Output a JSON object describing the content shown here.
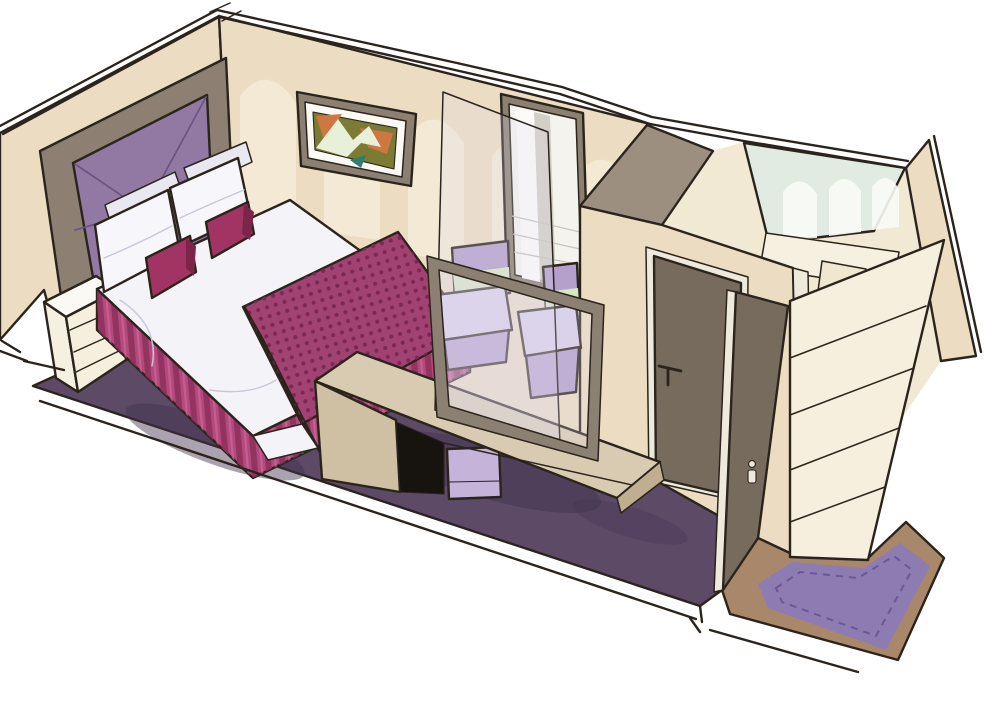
{
  "illustration": {
    "caption": "Hand-drawn cutaway illustration of an interior cabin: double bed with purple headboard and plum runner, framed abstract art, tall mirror, vanity desk with two lilac chairs behind a glass divider, bathroom with frosted arched glass, wardrobe shelves and entry door with rug",
    "objects": [
      "double-bed",
      "headboard",
      "pillows",
      "accent-pillows",
      "bed-runner",
      "bed-skirt",
      "nightstand",
      "wall-art",
      "mirror",
      "vanity-desk",
      "stool",
      "chairs",
      "glass-divider",
      "vanity-mirror-frame",
      "bathroom-door",
      "entry-door",
      "wardrobe-shelves",
      "bathroom-glass-wall",
      "bedroom-carpet",
      "entry-rug",
      "wood-floor"
    ]
  },
  "colors": {
    "paper": "#ffffff",
    "ink": "#2b241c",
    "wall": "#ecdcc2",
    "wallLight": "#f7efdd",
    "wallBackdrop": "#f2e9d4",
    "taupePanel": "#8d8073",
    "frameTaupe": "#8c8072",
    "purplePanel": "#9179a3",
    "purpleSeam": "#6b5480",
    "pillowWhite": "#f7f6fa",
    "pillowBack": "#e9e7f0",
    "magenta": "#a23463",
    "magentaDark": "#7c2449",
    "duvet": "#f4f3f8",
    "runner": "#a24273",
    "runnerDark": "#8f3763",
    "runnerDot": "#7a2a52",
    "skirt": "#b3497c",
    "skirtDark": "#8d2f5b",
    "pleatHighlight": "#cf6f9c",
    "carpet": "#5c4a67",
    "carpetShadow": "#42334e",
    "rug": "#8d7cb2",
    "rugBorder": "#6a5894",
    "wood": "#a8876b",
    "shelf": "#f6efdd",
    "deskTop": "#d9cbb1",
    "deskFront": "#cfc0a4",
    "deskEdge": "#bfae90",
    "deskHole": "#17130f",
    "stool": "#c6b3da",
    "chairMid": "#b4a0cb",
    "chairLight": "#d9cfe8",
    "chairGreen": "#d9e6c2",
    "doorDark": "#776b5e",
    "doorLight": "#efe9dc",
    "mirrorBg": "#f5f3ee",
    "mirrorStreak": "#c9c5bc",
    "mirrorWhite": "#fcfbf8",
    "bathGlass": "#e2ebe2",
    "bathArch": "#f9fbf6",
    "closetTop": "#9c8f80",
    "matWhite": "#fbf9f3",
    "artOlive": "#7b7b33",
    "artOrange": "#cf7743",
    "artMint": "#e9f0da",
    "artTeal": "#2f7d6d",
    "glassFill": "rgba(224,220,238,0.25)",
    "partition": "#f6f0e0",
    "partition2": "#efe7d2",
    "foldLine": "#c9c7d8"
  }
}
